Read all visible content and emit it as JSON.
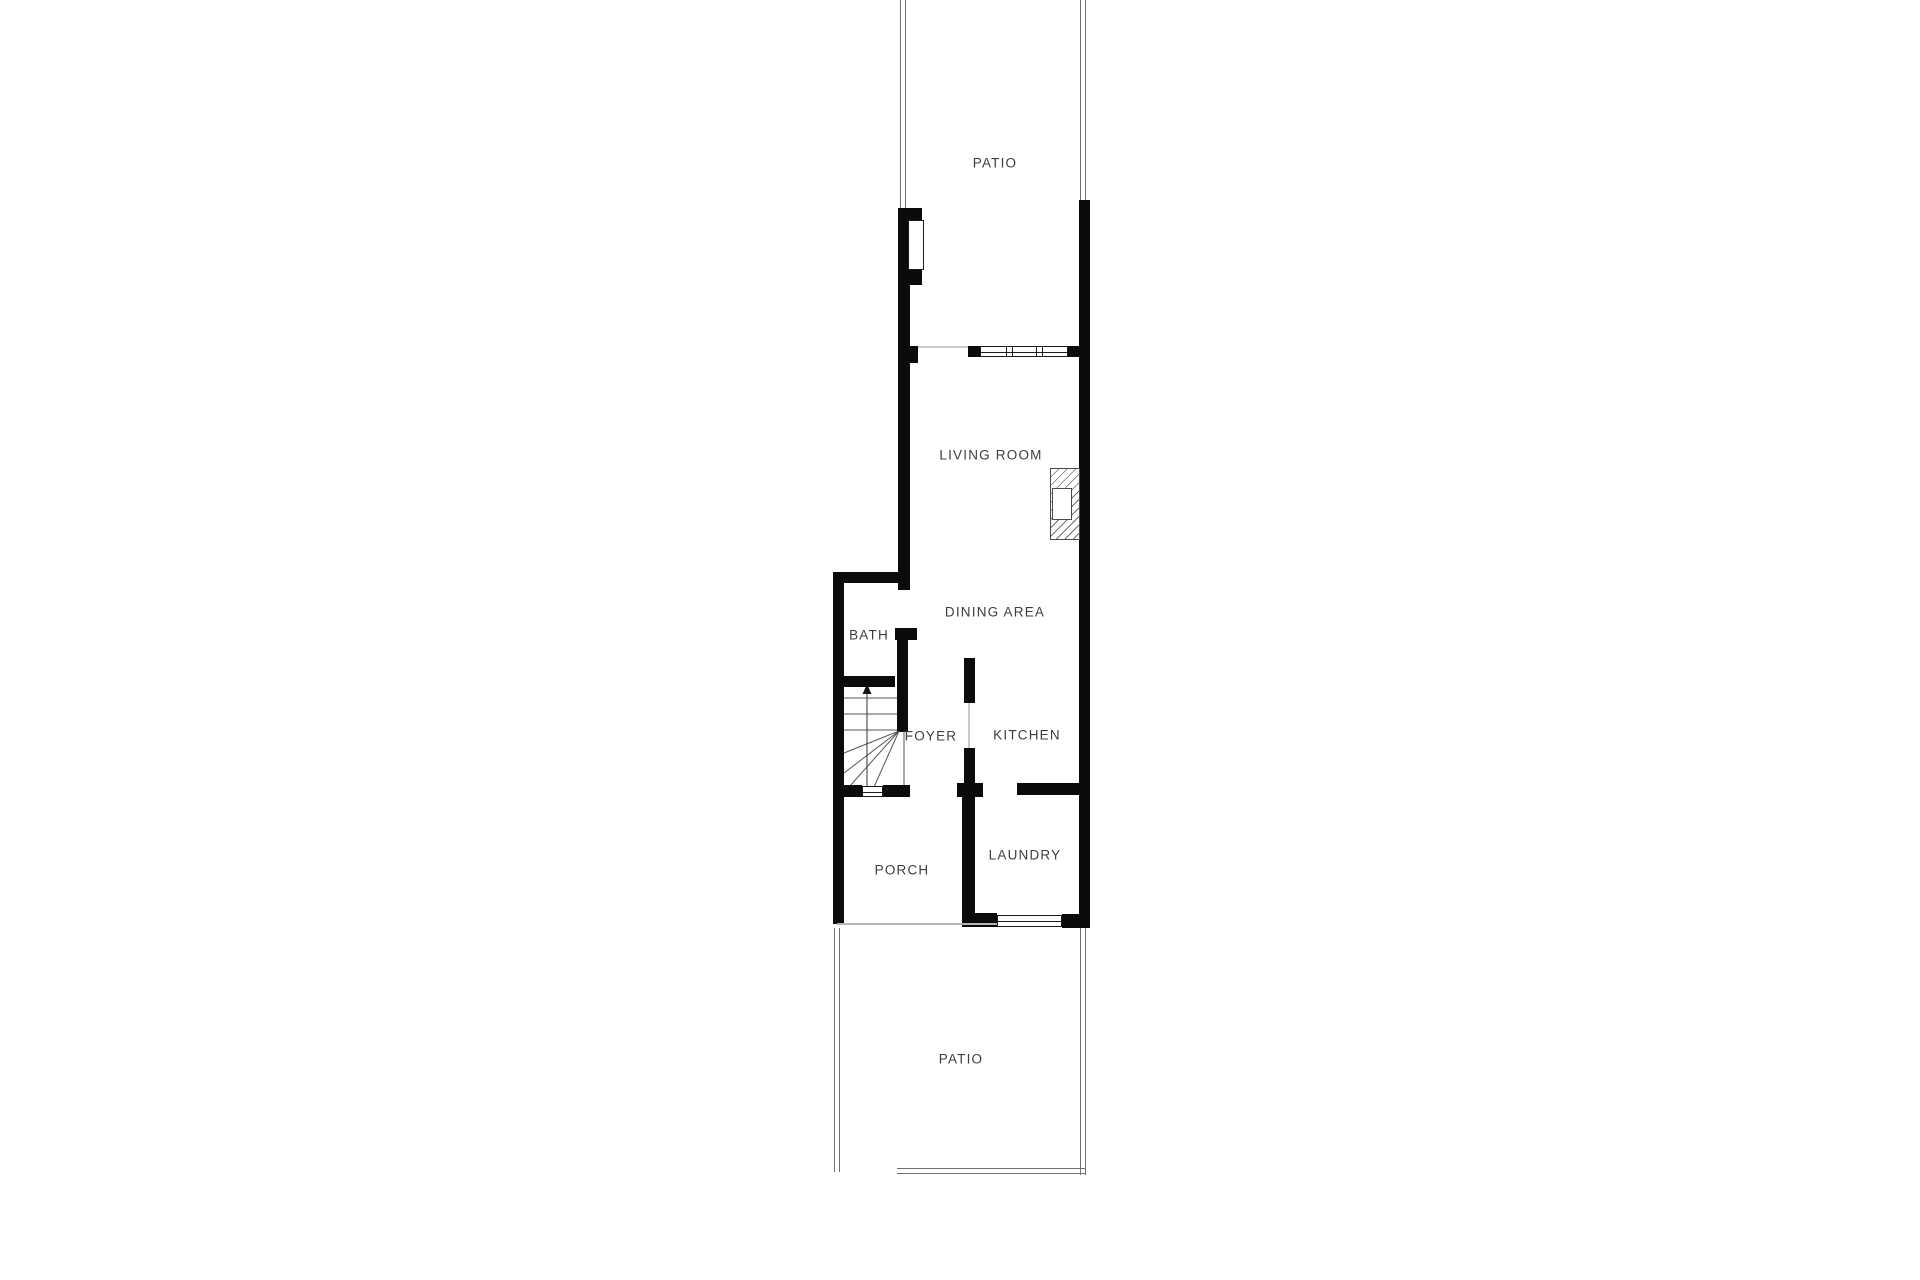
{
  "floorplan": {
    "rooms": {
      "patio_top": {
        "label": "PATIO"
      },
      "living_room": {
        "label": "LIVING ROOM"
      },
      "dining_area": {
        "label": "DINING AREA"
      },
      "bath": {
        "label": "BATH"
      },
      "foyer": {
        "label": "FOYER"
      },
      "kitchen": {
        "label": "KITCHEN"
      },
      "porch": {
        "label": "PORCH"
      },
      "laundry": {
        "label": "LAUNDRY"
      },
      "patio_bottom": {
        "label": "PATIO"
      }
    },
    "features": {
      "stairs_direction": "up",
      "fireplace_in_living_room": true
    },
    "colors": {
      "wall": "#0b0b0b",
      "label_text": "#3d3d3d",
      "patio_boundary": "#707070",
      "opening_line": "#c9c9c9"
    }
  }
}
